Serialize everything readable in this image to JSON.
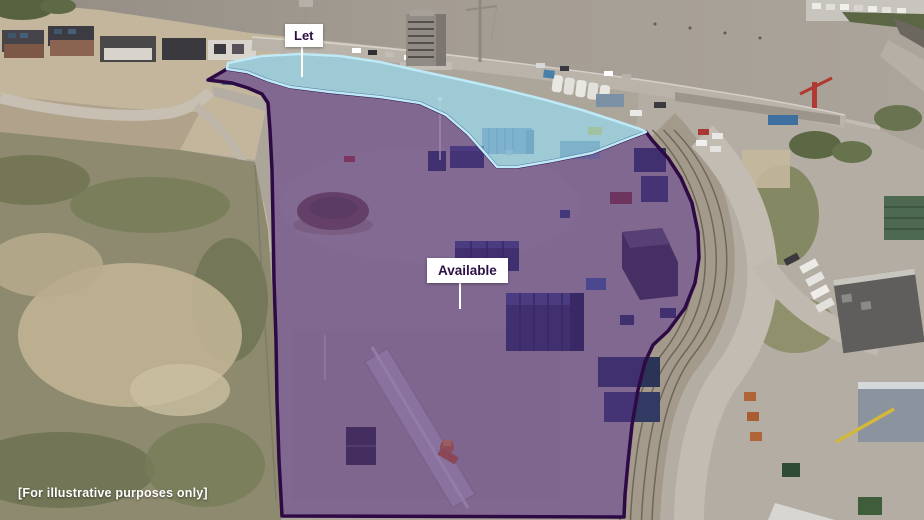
{
  "annotation_labels": {
    "let": "Let",
    "available": "Available"
  },
  "caption": "[For illustrative purposes only]",
  "colors": {
    "available_fill": "#5a2d8c",
    "available_border": "#2e0a45",
    "let_fill": "#7ecbe8",
    "let_border": "#bdeaf6",
    "label_text": "#2d1045",
    "label_bg": "#ffffff",
    "caption_text": "#ffffff"
  }
}
